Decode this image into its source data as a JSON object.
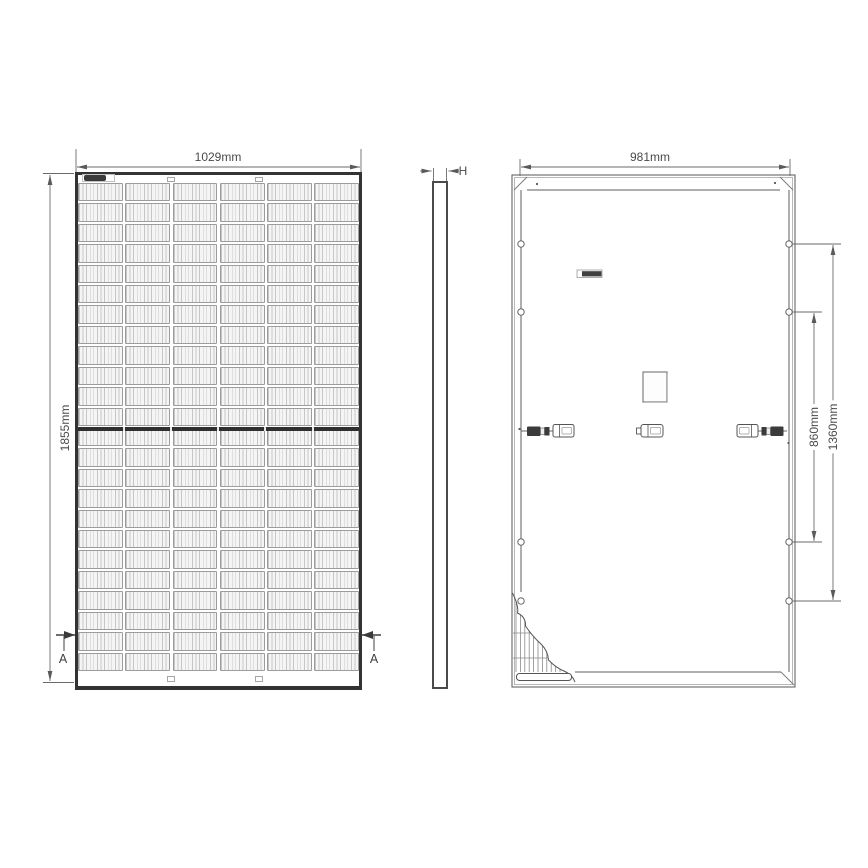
{
  "diagram": {
    "title": "solar-panel-technical-drawing",
    "views": {
      "front": {
        "width_label": "1029mm",
        "height_label": "1855mm",
        "section_marker_left": "A",
        "section_marker_right": "A",
        "cell_columns": 6,
        "cell_rows": 24
      },
      "side": {
        "thickness_label": "H"
      },
      "back": {
        "width_label": "981mm",
        "inner_hole_span_label": "860mm",
        "outer_hole_span_label": "1360mm",
        "mount_holes_per_side": 4
      }
    },
    "colors": {
      "line": "#555555",
      "frame_dark": "#333333",
      "cell_stripe": "#c6c6c6",
      "cell_fill": "#f5f5f5",
      "busbar": "#2f2f2f",
      "connector_dark": "#3b3b3b",
      "text": "#4a4a4a"
    }
  }
}
